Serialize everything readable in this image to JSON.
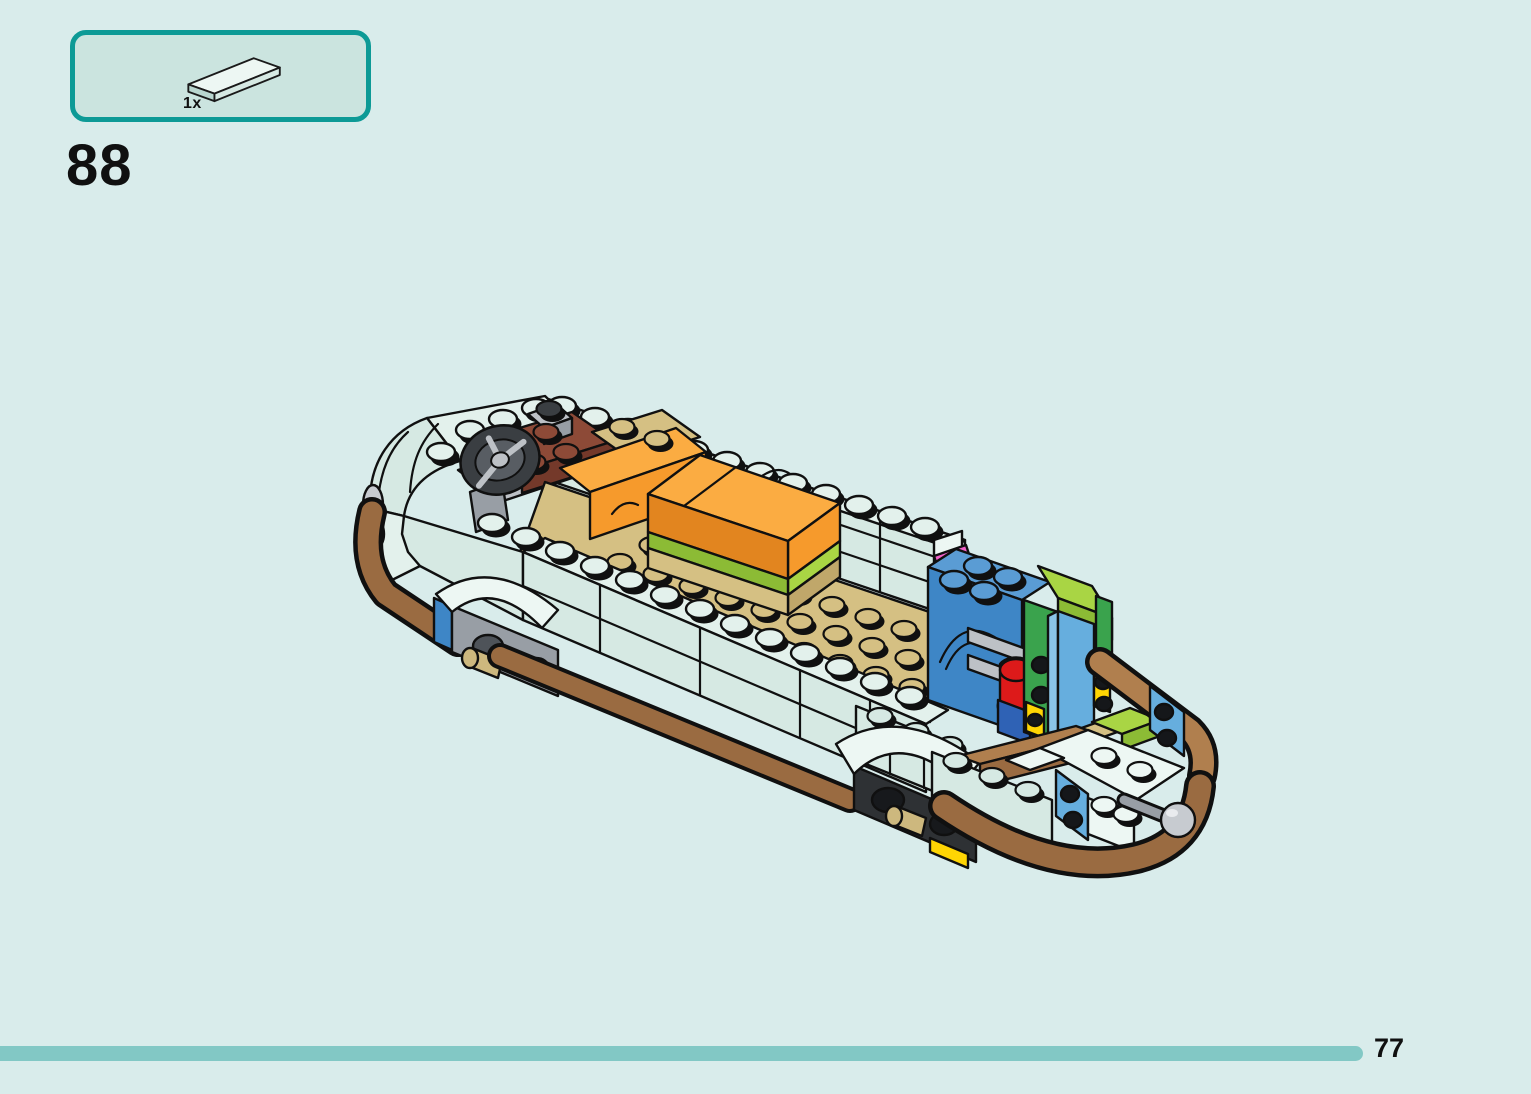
{
  "parts_panel": {
    "count_label": "1x",
    "piece_name": "1x4-tile-light-aqua",
    "border_color": "#0d9a96",
    "fill_color": "#cbe4df"
  },
  "step": {
    "number": "88"
  },
  "footer": {
    "page_number": "77",
    "progress_color": "#82c8c5",
    "progress_fraction": 0.89
  },
  "palette": {
    "page_bg": "#d9eceb",
    "panel_fill": "#cbe4df",
    "teal": "#0d9a96",
    "progress": "#82c8c5",
    "ink": "#101010",
    "aqua": "#d6e9e3",
    "aqua_light": "#e3f1ec",
    "aqua_pale": "#edf7f3",
    "aqua_dark": "#b9d6cf",
    "tan": "#d5c083",
    "tan_dark": "#c0a76a",
    "brown": "#9a6b41",
    "brown_light": "#b07f4e",
    "redbrown": "#8d4a37",
    "redbrown_dark": "#74392a",
    "orange": "#f69a2c",
    "orange_light": "#fbac42",
    "orange_dark": "#e2851f",
    "lime": "#a9d544",
    "lime_dark": "#8cbb35",
    "green": "#3aa34d",
    "blue": "#3e86c6",
    "blue_light": "#5a9cd4",
    "blue_dark": "#2f6da8",
    "blue2": "#2f62b5",
    "azure": "#66aede",
    "azure_light": "#8ac4e8",
    "magenta": "#f25fc9",
    "magenta_dark": "#d13ba8",
    "red": "#dd1a1a",
    "yellow": "#ffd503",
    "gray_light": "#bdc1c6",
    "gray_mid": "#989ea5",
    "gray_dark": "#4e5359",
    "silver": "#c7cbd0",
    "gold": "#cdb87e",
    "tire": "#3a3e42"
  }
}
